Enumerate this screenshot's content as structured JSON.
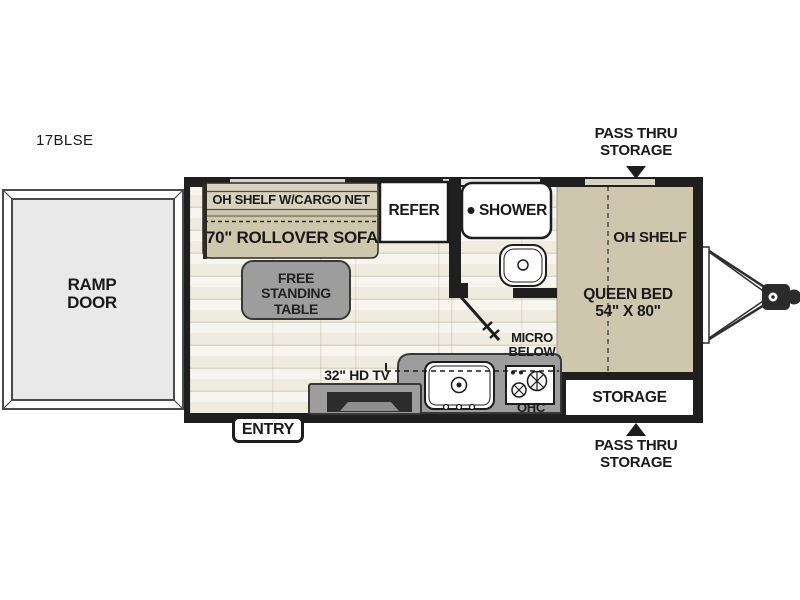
{
  "model_label": "17BLSE",
  "colors": {
    "wall": "#1f1f1f",
    "furniture_tan": "#cfc6ae",
    "shelf_tan": "#d8d1bd",
    "furniture_gray": "#9d9d9d",
    "floor": "#f5f3ec",
    "ramp_fill": "#e9e9e9",
    "text": "#1a1a1a"
  },
  "exterior": {
    "ramp_door_label": "RAMP DOOR",
    "entry_label": "ENTRY",
    "pass_thru_storage_front_label": "PASS THRU STORAGE",
    "pass_thru_storage_rear_label": "PASS THRU STORAGE"
  },
  "living_area": {
    "overhead_shelf_label": "OH SHELF W/CARGO NET",
    "sofa_label": "70\" ROLLOVER SOFA",
    "table_label": "FREE STANDING TABLE",
    "tv_label": "32\" HD TV"
  },
  "kitchen": {
    "refrigerator_label": "REFER",
    "microwave_label": "MICRO BELOW",
    "overhead_cabinet_label": "OHC"
  },
  "bathroom": {
    "shower_label": "SHOWER"
  },
  "bedroom": {
    "overhead_shelf_label": "OH SHELF",
    "bed_label": "QUEEN BED 54\" X 80\"",
    "storage_label": "STORAGE"
  }
}
